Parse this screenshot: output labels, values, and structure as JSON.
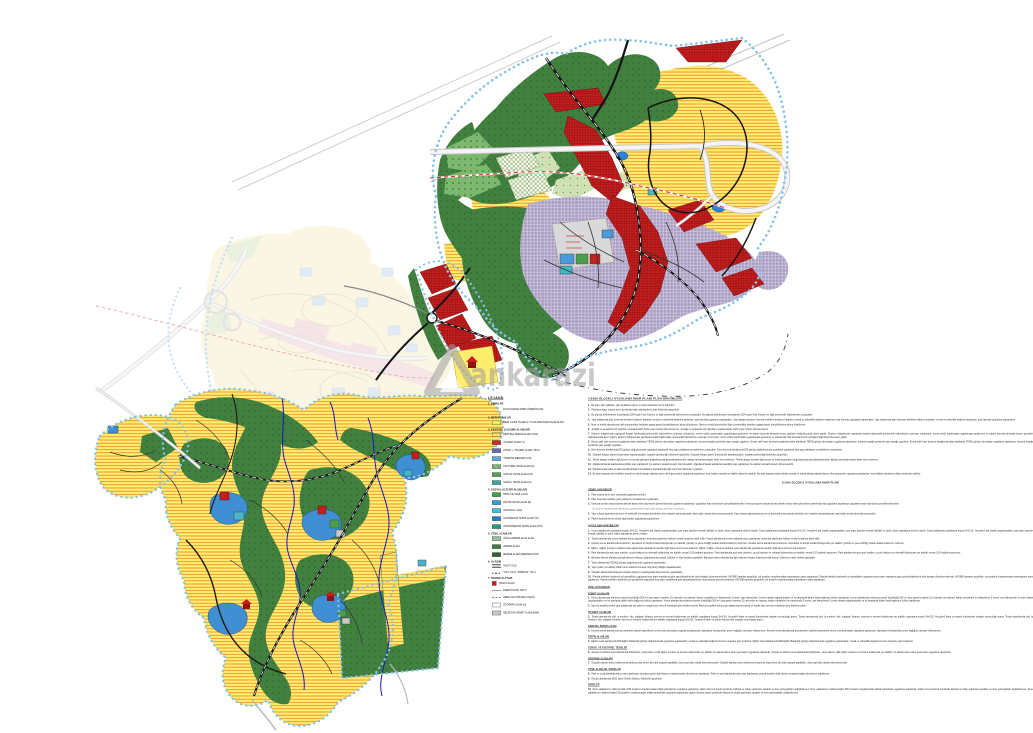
{
  "watermark": {
    "text": "ankarazi"
  },
  "palette": {
    "residential_yellow": "#ffee6e",
    "residential_hatch": "#e07a20",
    "commercial_red": "#c41e1e",
    "commercial_grid": "#7e0d0d",
    "mixed_purple": "#b1a5c8",
    "forest_green": "#41803f",
    "park_green": "#7db86f",
    "sage_green": "#cfe0b4",
    "facility_blue": "#3f8fd2",
    "pond_blue": "#2f80d8",
    "stream_blue": "#1818c8",
    "boundary_blue": "#86c2ea",
    "faded_yellow": "#f7efc8",
    "faded_pink": "#f0cfd4",
    "highway_gray": "#c9c9c9",
    "parcel_gray": "#d9d9d9",
    "metro_dash_red": "#d03030",
    "watermark_gray": "#9e9e9e"
  },
  "legend": {
    "title": "LEJAND",
    "sections": [
      {
        "heading": "1. SINIRLAR",
        "items": [
          {
            "swatch": "boundary",
            "label": "PLAN ONAMA SINIRI (ÖNERİ PLAN)"
          }
        ]
      },
      {
        "heading": "2. MERİ PLANLAR",
        "items": [
          {
            "swatch": "yellow",
            "label": "MERİ 1/1000 ÖLÇEKLİ UYGULAMA İMAR PLANI ALANI"
          }
        ]
      },
      {
        "heading": "3. KENTSEL ÇALIŞMA ALANLARI",
        "items": [
          {
            "swatch": "redx",
            "label": "KENTSEL SERVİS ALANI (KSA)"
          },
          {
            "swatch": "red",
            "label": "TİCARET ALANI (T)"
          },
          {
            "swatch": "indigo",
            "label": "KONUT + TİCARET ALANI (TİCK)"
          },
          {
            "swatch": "ltblue",
            "label": "YÖNETİM MERKEZİ (YM)"
          },
          {
            "swatch": "hatchgreen",
            "label": "KÜLTÜREL TESİS ALANI (K)"
          },
          {
            "swatch": "green",
            "label": "SOSYAL TESİS ALANI (ST)"
          },
          {
            "swatch": "teal",
            "label": "SAĞLIK TESİSİ ALANI (S)"
          }
        ]
      },
      {
        "heading": "4. SOSYAL ALTYAPI ALANLARI",
        "items": [
          {
            "swatch": "park",
            "label": "PARK VE YEŞİL ALAN"
          },
          {
            "swatch": "blue",
            "label": "EĞİTİM TESİSİ ALANI (E)"
          },
          {
            "swatch": "cyan",
            "label": "ANAOKULU (AO)"
          },
          {
            "swatch": "blue2",
            "label": "İLKÖĞRETİM TESİSİ ALANI (İÖ)"
          },
          {
            "swatch": "tealgreen",
            "label": "ORTAÖĞRETİM TESİSİ ALANI (OÖ)"
          }
        ]
      },
      {
        "heading": "5. YEŞİL ALANLAR",
        "items": [
          {
            "swatch": "lgreendot",
            "label": "AĞAÇLANDIRILACAK ALAN"
          },
          {
            "swatch": "forest",
            "label": "ORMAN ALANI"
          },
          {
            "swatch": "dgreen",
            "label": "MESİRE ALANI (REKREASYON)"
          }
        ]
      },
      {
        "heading": "6. ULAŞIM",
        "items": [
          {
            "swatch": "roadsym",
            "label": "TAŞIT YOLU"
          },
          {
            "swatch": "roaddash",
            "label": "YAYA YOLU / BİSİKLET YOLU"
          }
        ]
      },
      {
        "heading": "7. TEKNİK ALTYAPI",
        "items": [
          {
            "swatch": "trafo",
            "label": "TRAFO ALANI"
          },
          {
            "swatch": "powerline",
            "label": "ENERJİ NAKİL HATTI"
          },
          {
            "swatch": "dereline",
            "label": "DERE VE KORUMA KUŞAĞI"
          },
          {
            "swatch": "whitebox",
            "label": "OTOPARK ALANI (O)"
          },
          {
            "swatch": "graybox",
            "label": "BELEDİYE HİZMET ALANI (BHA)"
          }
        ]
      }
    ]
  },
  "notes": {
    "blocks": [
      {
        "t": "title",
        "x": "1/1000 ÖLÇEKLİ UYGULAMA İMAR PLANI PLAN HÜKÜMLERİ"
      },
      {
        "t": "p",
        "n": "1.",
        "r": 1,
        "x": "Bu plan; plan paftaları, plan açıklama raporu ve plan hükümleri ile bir bütündür."
      },
      {
        "t": "p",
        "n": "2.",
        "r": 1,
        "x": "Planlama alanı onama sınırı içerisinde kalan alanlarda bu plan hükümleri geçerlidir."
      },
      {
        "t": "p",
        "n": "3.",
        "r": 2,
        "x": "Bu planda belirtilmeyen hususlarda 3194 sayılı İmar Kanunu ve ilgili yönetmelik hükümlerine uyulacaktır."
      },
      {
        "t": "p",
        "n": "4.",
        "r": 3,
        "x": "Yapı adalarında plan üzerinde belirtilen kullanım kararları, emsal ve yükseklik değerleri aşılamaz; ada bazında uygulama yapılacaktır."
      },
      {
        "t": "p",
        "n": "5.",
        "r": 2,
        "x": "İfraz ve tevhid işlemlerinde ilgili yönetmelikte belirtilen asgari parsel büyüklüklerinin altına düşülemez."
      },
      {
        "t": "p",
        "n": "6.",
        "r": 2,
        "x": "Jeolojik ve jeoteknik etüt raporları onaylanmadan hiçbir yapı ruhsatı düzenlenemez."
      },
      {
        "t": "p",
        "n": "7.",
        "r": 3,
        "x": "Deprem bölgelerinde yapılacak binalar hakkındaki yönetmelik hükümlerine uyulması zorunludur; zemin etüdü yapılmadan uygulamaya geçilemez ve parsel bazında alınacak kurum görüşleri doğrultusunda işlem yapılır."
      },
      {
        "t": "p",
        "n": "8.",
        "r": 3,
        "x": "Enerji nakil hattı koruma kuşağında kalan alanlarda TEİAŞ görüşü alınmadan uygulama yapılamaz; koruma kuşağı içerisinde yapı yasağı uygulanır."
      },
      {
        "t": "p",
        "n": "9.",
        "r": 2,
        "x": "Dere koruma bantlarında DSİ görüşü doğrultusunda uygulama yapılacak olup yapı yaklaşma mesafelerine uyulacaktır."
      },
      {
        "t": "p",
        "n": "10.",
        "r": 2,
        "x": "Otopark ihtiyacı parsel bünyesinde karşılanacaktır; otopark yönetmeliği hükümleri geçerlidir."
      },
      {
        "t": "p",
        "n": "11.",
        "r": 2,
        "x": "Teknik altyapı tesisleri ilgili kurum ve kuruluş görüşleri doğrultusunda gerçekleştirilecektir; altyapı tamamlanmadan iskân izni verilemez."
      },
      {
        "t": "p",
        "n": "12.",
        "r": 2,
        "x": "Ağaçlandırılacak alanlarda kesinlikle yapı yapılamaz; bu alanlar rekreatif amaçlı düzenlenebilir."
      },
      {
        "t": "p",
        "n": "13.",
        "r": 1,
        "x": "Planlama alanında yer alan tescilli parseller ile kadastro boşluklarında ilgili mevzuat hükümleri uygulanır."
      },
      {
        "t": "p",
        "n": "14.",
        "r": 2,
        "x": "Bu plan kapsamında belirtilen sosyal ve teknik altyapı alanları kamu eline geçmeden uygulama yapılamaz; imar hakları transferine ilişkin hükümler saklıdır."
      },
      {
        "t": "h",
        "x": "1/1000 ÖLÇEKLİ UYGULAMA İMAR PLANI"
      },
      {
        "t": "s",
        "x": "GENEL HÜKÜMLER"
      },
      {
        "t": "p",
        "n": "1.",
        "r": 1,
        "x": "Plan onama sınırı aynı zamanda uygulama sınırıdır."
      },
      {
        "t": "p",
        "n": "2.",
        "r": 1,
        "x": "Plan üzerinde belirtilen yapı yaklaşma mesafelerine uyulacaktır."
      },
      {
        "t": "p",
        "n": "3.",
        "r": 2,
        "x": "Kamuya ayrılan sosyal donatı alanları kamu eline geçmeden parsel bazında uygulama yapılamaz; uygulama etap bütününde gerçekleştirilecektir."
      },
      {
        "t": "pm",
        "r": 1,
        "x": "Bu hüküm kapsamında yapılacak uygulamalarda ilgili idare görüşü alınması zorunludur."
      },
      {
        "t": "p",
        "n": "4.",
        "r": 2,
        "x": "Yapı ruhsatı aşamasında çevre ve şehircilik mevzuatında belirtilen tüm belgeler tamamlanacak, aksi halde ruhsat düzenlenmeyecektir."
      },
      {
        "t": "p",
        "n": "5.",
        "r": 1,
        "x": "Parsel bazında zemin etüdü yapılmadan uygulamaya geçilemez."
      },
      {
        "t": "s",
        "x": "UYGULAMA HÜKÜMLERİ"
      },
      {
        "t": "p",
        "n": "1.",
        "r": 3,
        "x": "Konut adalarında yapılaşma koşulu E=0.30, Yençok=2 kat olarak uygulanacaktır; çatı arası piyesler emsale dahildir ve ayrık nizam yapılaşma düzeni esastır."
      },
      {
        "t": "p",
        "n": "2.",
        "r": 2,
        "x": "Ticaret alanlarında zemin katlarda konut yapılamaz; asma kat yapılması halinde emsal hesabına dahil edilir."
      },
      {
        "t": "p",
        "n": "3.",
        "r": 2,
        "x": "Kentsel servis alanlarında showroom, depolama ve küçük imalat fonksiyonları yer alabilir; gürültü ve çevre kirliliği yaratan kullanımlara izin verilmez."
      },
      {
        "t": "p",
        "n": "4.",
        "r": 2,
        "x": "Eğitim, sağlık, sosyal ve kültürel tesis alanlarında yapılaşma koşulları ilgili kamu kurumunca belirlenir."
      },
      {
        "t": "p",
        "n": "5.",
        "r": 3,
        "x": "Park alanlarında açık spor tesisleri, çocuk bahçesi ve rekreatif kullanımlar yer alabilir; emsal 0.03 değerini geçemez."
      },
      {
        "t": "p",
        "n": "6.",
        "r": 2,
        "x": "Belediye hizmet alanlarında ilgili idarenin ihtiyacı doğrultusunda sosyal, kültürel ve idari tesisler yapılabilir."
      },
      {
        "t": "p",
        "n": "7.",
        "r": 1,
        "x": "Trafo alanlarında TEDAŞ görüşü doğrultusunda uygulama yapılacaktır."
      },
      {
        "t": "p",
        "n": "8.",
        "r": 1,
        "x": "Yaya yolları ve bisiklet yolları kamu kullanımına açık olup araç trafiğine kapatılacaktır."
      },
      {
        "t": "p",
        "n": "9.",
        "r": 1,
        "x": "Otopark alanlarında bölgesel otopark ihtiyacını karşılayacak düzenlemeler yapılacaktır."
      },
      {
        "t": "p",
        "n": "10.",
        "r": 3,
        "x": "Planda belirtilen kademeli yol genişlikleri uygulama imar planı esaslarına göre gerçekleştirilecek olup kavşak düzenlemelerinde UKOME kararları geçerlidir; yol projeleri onaylanmadan parselasyon planı yapılamaz."
      },
      {
        "t": "s",
        "x": "ÖZEL HÜKÜMLER"
      },
      {
        "t": "s2",
        "x": "KONUT ALANLARI"
      },
      {
        "t": "p",
        "n": "1.",
        "r": 3,
        "x": "Konut alanlarında minimum parsel büyüklüğü 500 m² olup parsel cephesi 15 metreden az olamaz; bahçe mesafeleri ön bahçelerde 5 metre, yan bahçelerde 3 metre olarak uygulanacaktır ve bu alanlarda ikiden fazla bağımsız bölüm yapılamaz."
      },
      {
        "t": "p",
        "n": "2.",
        "r": 2,
        "x": "Mevcut teşekkül etmiş yapı adalarında kat adedi ve saçak kotu mevcut teşekküle göre belirlenecektir."
      },
      {
        "t": "s2",
        "x": "TİCARET ALANLARI"
      },
      {
        "t": "p",
        "n": "3.",
        "r": 3,
        "x": "Ticaret alanlarında otel, iş merkezi, ofis, mağaza, lokanta, sinema ve benzeri kullanımlar yer alabilir; yapılaşma koşulu E=0.50, Yençok=3 kattır ve parsel bünyesinde otopark zorunluluğu aranır."
      },
      {
        "t": "s2",
        "x": "KENTSEL SERVİS ALANI"
      },
      {
        "t": "p",
        "n": "4.",
        "r": 2,
        "x": "Kentsel servis alanlarında ana arterlere cepheli parsellerde servis yolu alınmadan uygulama yapılamaz; depolama fonksiyonları çevre sağlığını olumsuz etkileyemez."
      },
      {
        "t": "s2",
        "x": "EĞİTİM ALANLARI"
      },
      {
        "t": "p",
        "n": "5.",
        "r": 2,
        "x": "Eğitim tesisi alanlarında Milli Eğitim Bakanlığı görüşü doğrultusunda uygulama yapılacaktır; emsal ve yükseklik değerleri kurum projesine göre belirlenir."
      },
      {
        "t": "s2",
        "x": "SOSYAL VE KÜLTÜREL TESİSLER"
      },
      {
        "t": "p",
        "n": "6.",
        "r": 2,
        "x": "Sosyal ve kültürel tesis alanlarında kütüphane, sergi salonu, halk eğitim merkezi ve benzeri kullanımlar yer alabilir; bu alanlar kamu eline geçmeden uygulama yapılamaz."
      },
      {
        "t": "s2",
        "x": "OTOPARK ALANLARI"
      },
      {
        "t": "p",
        "n": "7.",
        "r": 2,
        "x": "Otopark alanları kamu kullanımına ayrılmış olup zemin altı katlı otopark yapılabilir; üstü yeşil alan olarak düzenlenecektir."
      },
      {
        "t": "s2",
        "x": "YEŞİL ALANLAR / PARKLAR"
      },
      {
        "t": "p",
        "n": "8.",
        "r": 2,
        "x": "Park ve yeşil alanlarda kalıcı yapı yapılamaz; peyzaj projeleri ilgili idarece onaylanmadan düzenleme yapılamaz."
      },
      {
        "t": "p",
        "n": "9.",
        "r": 1,
        "x": "Orman alanlarında 6831 sayılı Orman Kanunu hükümleri geçerlidir."
      },
      {
        "t": "s2",
        "x": "DERELER"
      },
      {
        "t": "p",
        "n": "10.",
        "r": 3,
        "x": "Dere yataklarının ıslahına ilişkin DSİ projeleri onaylanmadan bitişik parsellerde uygulama yapılamaz; taşkın koruma bandı içerisinde hafriyat ve dolgu yapılması yasaktır ve dere güzergahları değiştirilemez."
      }
    ]
  }
}
